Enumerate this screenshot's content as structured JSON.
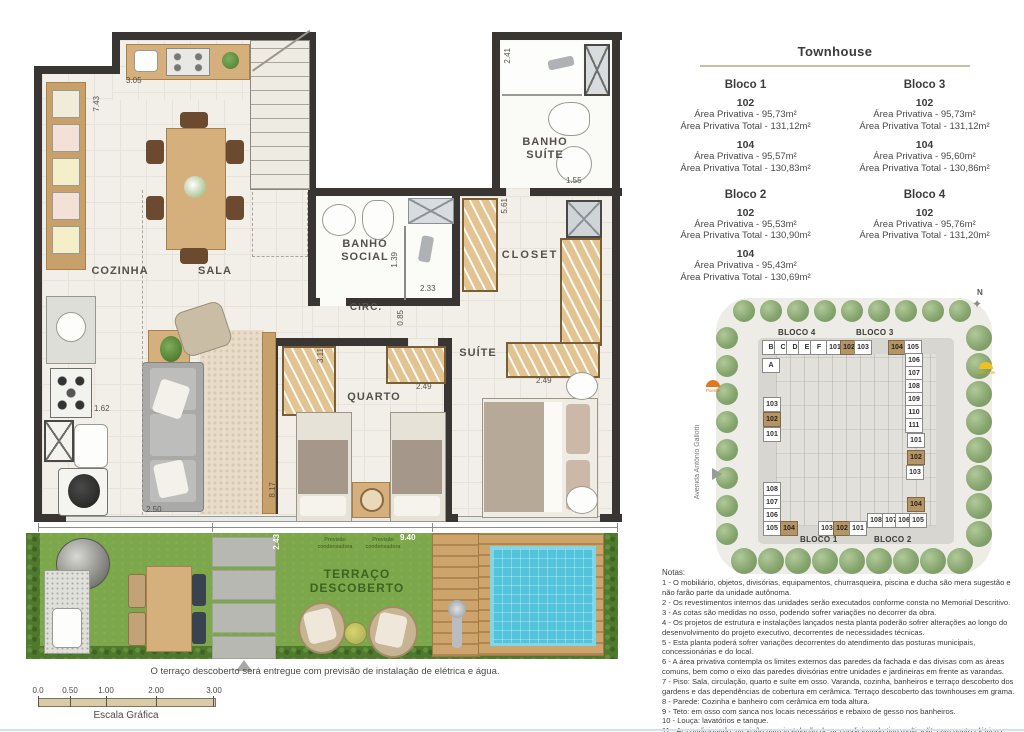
{
  "floorplan": {
    "rooms": {
      "cozinha": "COZINHA",
      "sala": "SALA",
      "banho_suite": "BANHO\nSUÍTE",
      "banho_social": "BANHO\nSOCIAL",
      "circ": "CIRC.",
      "closet": "CLOSET",
      "quarto": "QUARTO",
      "suite": "SUÍTE",
      "terraco": "TERRAÇO\nDESCOBERTO"
    },
    "stairs_label": "S ▸",
    "dims": {
      "cozinha_width": "3.05",
      "left_height": "7.43",
      "banho_suite_height": "2.41",
      "banho_suite_width": "1.55",
      "kitchen_counter": "1.62",
      "banho_social_shower": "1.39",
      "banho_social_width": "2.33",
      "circ_width": "0.85",
      "suite_wall": "5.61",
      "quarto_width": "3.11",
      "quarto_wardrobe": "2.49",
      "suite_wardrobe": "2.49",
      "sala_width": "2.50",
      "sala_depth": "8.17",
      "terrace_depth": "2.43",
      "terrace_width": "9.40"
    },
    "terrace_note_1": "Previsão\ncondensadora",
    "terrace_note_2": "Previsão\ncondensadora",
    "caption": "O terraço descoberto será entregue com previsão de instalação de elétrica e água."
  },
  "scalebar": {
    "ticks": [
      "0.0",
      "0.50",
      "1.00",
      "2.00",
      "3.00"
    ],
    "label": "Escala Gráfica"
  },
  "panel": {
    "title": "Townhouse",
    "blocks": [
      {
        "name": "Bloco 1",
        "units": [
          {
            "num": "102",
            "area": "Área Privativa - 95,73m²",
            "total": "Área Privativa Total - 131,12m²"
          },
          {
            "num": "104",
            "area": "Área Privativa - 95,57m²",
            "total": "Área Privativa Total - 130,83m²"
          }
        ]
      },
      {
        "name": "Bloco 3",
        "units": [
          {
            "num": "102",
            "area": "Área Privativa - 95,73m²",
            "total": "Área Privativa Total - 131,12m²"
          },
          {
            "num": "104",
            "area": "Área Privativa - 95,60m²",
            "total": "Área Privativa Total - 130,86m²"
          }
        ]
      },
      {
        "name": "Bloco 2",
        "units": [
          {
            "num": "102",
            "area": "Área Privativa - 95,53m²",
            "total": "Área Privativa Total - 130,90m²"
          },
          {
            "num": "104",
            "area": "Área Privativa - 95,43m²",
            "total": "Área Privativa Total - 130,69m²"
          }
        ]
      },
      {
        "name": "Bloco 4",
        "units": [
          {
            "num": "102",
            "area": "Área Privativa - 95,76m²",
            "total": "Área Privativa Total - 131,20m²"
          }
        ]
      }
    ]
  },
  "siteplan": {
    "labels": {
      "bloco4": "BLOCO 4",
      "bloco3": "BLOCO 3",
      "bloco1": "BLOCO 1",
      "bloco2": "BLOCO 2"
    },
    "street": "Avenida Antônio Gallotti",
    "compass": "N",
    "sun_west": "Poente",
    "sun_east": "Nascente",
    "cells": [
      {
        "label": "B",
        "x": 771,
        "y": 347,
        "hl": false
      },
      {
        "label": "C",
        "x": 783,
        "y": 347,
        "hl": false
      },
      {
        "label": "D",
        "x": 795,
        "y": 347,
        "hl": false
      },
      {
        "label": "E",
        "x": 807,
        "y": 347,
        "hl": false
      },
      {
        "label": "F",
        "x": 819,
        "y": 347,
        "hl": false
      },
      {
        "label": "101",
        "x": 835,
        "y": 347,
        "hl": false
      },
      {
        "label": "102",
        "x": 849,
        "y": 347,
        "hl": true
      },
      {
        "label": "103",
        "x": 863,
        "y": 347,
        "hl": false
      },
      {
        "label": "104",
        "x": 897,
        "y": 347,
        "hl": true
      },
      {
        "label": "105",
        "x": 913,
        "y": 347,
        "hl": false
      },
      {
        "label": "A",
        "x": 771,
        "y": 365,
        "hl": false
      },
      {
        "label": "103",
        "x": 772,
        "y": 404,
        "hl": false
      },
      {
        "label": "102",
        "x": 772,
        "y": 419,
        "hl": true
      },
      {
        "label": "101",
        "x": 772,
        "y": 434,
        "hl": false
      },
      {
        "label": "108",
        "x": 772,
        "y": 489,
        "hl": false
      },
      {
        "label": "107",
        "x": 772,
        "y": 502,
        "hl": false
      },
      {
        "label": "106",
        "x": 772,
        "y": 515,
        "hl": false
      },
      {
        "label": "105",
        "x": 772,
        "y": 528,
        "hl": false
      },
      {
        "label": "104",
        "x": 789,
        "y": 528,
        "hl": true
      },
      {
        "label": "103",
        "x": 827,
        "y": 528,
        "hl": false
      },
      {
        "label": "102",
        "x": 842,
        "y": 528,
        "hl": true
      },
      {
        "label": "101",
        "x": 858,
        "y": 528,
        "hl": false
      },
      {
        "label": "108",
        "x": 876,
        "y": 520,
        "hl": false
      },
      {
        "label": "107",
        "x": 891,
        "y": 520,
        "hl": false
      },
      {
        "label": "106",
        "x": 904,
        "y": 520,
        "hl": false
      },
      {
        "label": "105",
        "x": 918,
        "y": 520,
        "hl": false
      },
      {
        "label": "106",
        "x": 914,
        "y": 360,
        "hl": false
      },
      {
        "label": "107",
        "x": 914,
        "y": 373,
        "hl": false
      },
      {
        "label": "108",
        "x": 914,
        "y": 386,
        "hl": false
      },
      {
        "label": "109",
        "x": 914,
        "y": 399,
        "hl": false
      },
      {
        "label": "110",
        "x": 914,
        "y": 412,
        "hl": false
      },
      {
        "label": "111",
        "x": 914,
        "y": 425,
        "hl": false
      },
      {
        "label": "101",
        "x": 916,
        "y": 440,
        "hl": false
      },
      {
        "label": "102",
        "x": 916,
        "y": 457,
        "hl": true
      },
      {
        "label": "103",
        "x": 915,
        "y": 472,
        "hl": false
      },
      {
        "label": "104",
        "x": 916,
        "y": 504,
        "hl": true
      }
    ]
  },
  "notes": {
    "title": "Notas:",
    "items": [
      "1 - O mobiliário, objetos, divisórias, equipamentos, churrasqueira, piscina e ducha são mera sugestão e não farão parte da unidade autônoma.",
      "2 - Os revestimentos internos das unidades serão executados conforme consta no Memorial Descritivo.",
      "3 - As cotas são medidas no osso, podendo sofrer variações no decorrer da obra.",
      "4 - Os projetos de estrutura e instalações lançados nesta planta poderão sofrer alterações ao longo do desenvolvimento do projeto executivo, decorrentes de necessidades técnicas.",
      "5 - Esta planta poderá sofrer variações decorrentes do atendimento das posturas municipais, concessionárias e do local.",
      "6 - A área privativa contempla os limites externos das paredes da fachada e das divisas com as áreas comuns, bem como o eixo das paredes divisórias entre unidades e jardineiras em frente as varandas.",
      "7 - Piso: Sala, circulação, quarto e suíte em osso. Varanda, cozinha, banheiros e terraço descoberto dos gardens e das dependências de cobertura em cerâmica. Terraço descoberto das townhouses em grama.",
      "8 - Parede: Cozinha e banheiro com cerâmica em toda altura.",
      "9 - Teto: em osso com sanca nos locais necessários e rebaixo de gesso nos banheiros.",
      "10 - Louça: lavatórios e tanque.",
      "11 - Ar-condicionado: previsão para instalação de ar-condicionado tipo multi split, com ponto elétrico e dreno, que deverá ser instalado conforme projeto. A previsão das condensadoras irá variar conforme projeto de fachada."
    ]
  }
}
